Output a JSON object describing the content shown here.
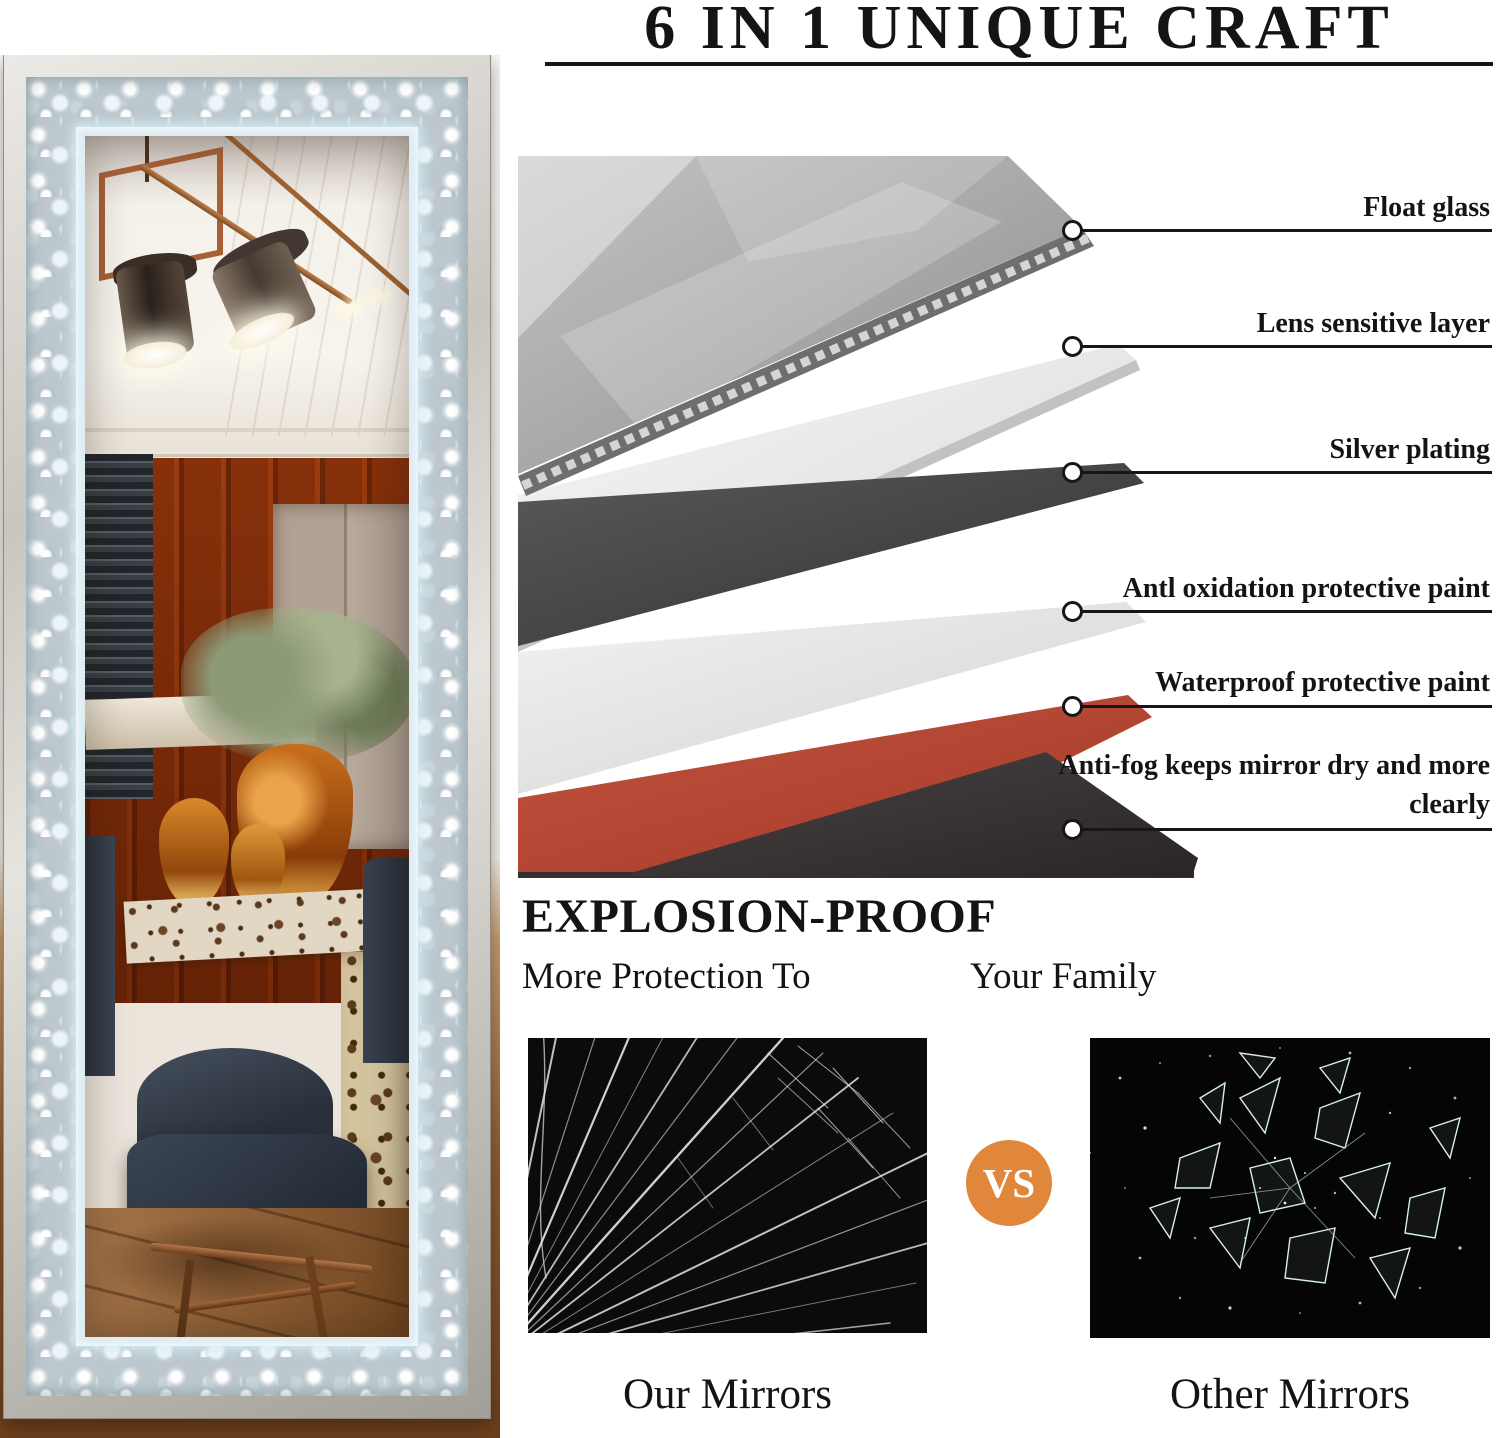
{
  "title": {
    "text": "6 IN 1 UNIQUE CRAFT"
  },
  "layer_callouts": {
    "items": [
      {
        "label": "Float glass"
      },
      {
        "label": "Lens sensitive layer"
      },
      {
        "label": "Silver plating"
      },
      {
        "label": "Antl oxidation protective paint"
      },
      {
        "label": "Waterproof protective paint"
      },
      {
        "label": "Anti-fog keeps mirror dry and more clearly"
      }
    ]
  },
  "explosion": {
    "heading": "EXPLOSION-PROOF",
    "subtitle_left": "More Protection To",
    "subtitle_right": "Your Family",
    "vs_label": "VS",
    "our_caption": "Our Mirrors",
    "other_caption": "Other Mirrors"
  },
  "colors": {
    "vs_badge_orange": "#E0873C",
    "waterproof_layer_red": "#B04431",
    "led_edge_blue": "#DCEDF3",
    "ink": "#141414"
  }
}
